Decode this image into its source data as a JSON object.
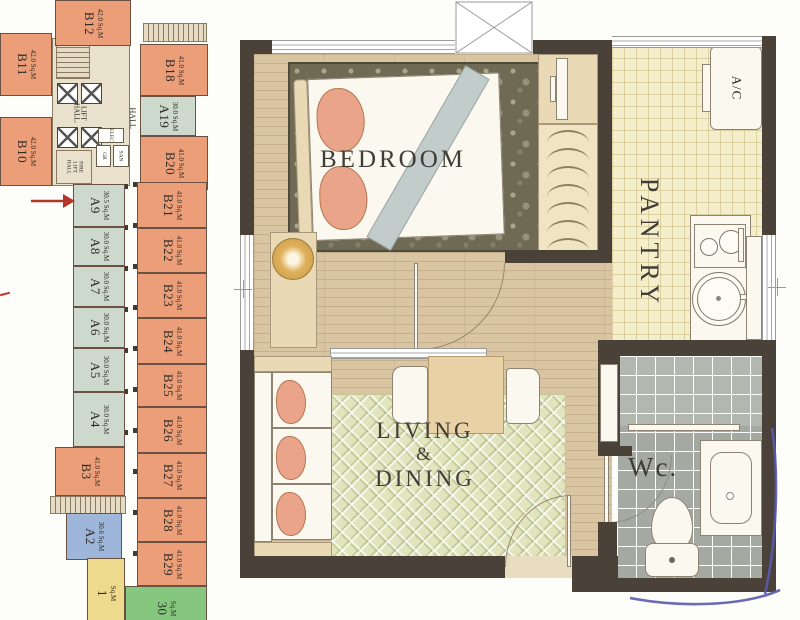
{
  "document": {
    "type": "scanned condominium floor plan"
  },
  "colors": {
    "unit_orange": "#EC9E79",
    "unit_sage": "#CDD9CC",
    "unit_blue": "#9DB6DA",
    "unit_yellow": "#EEDA8C",
    "unit_green": "#85C77F",
    "wall_dark": "#4A4138",
    "wood_floor": "#D9C5A1",
    "pantry_floor": "#F4EECA",
    "wc_tile": "#A4AAA1",
    "bedroom_rug": "#6E6A54",
    "living_rug": "#E1E4BD",
    "pillow_salmon": "#E9A489",
    "arrow_red": "#B5372A",
    "pen_blue": "#5A5AAD"
  },
  "left_plan": {
    "marker": {
      "shape": "arrow",
      "color": "#B5372A",
      "points_to": "A9"
    },
    "core": {
      "lift_hall_line1": "LIFT",
      "lift_hall_line2": "HALL.",
      "hall": "HALL",
      "fire_line1": "FIRE",
      "fire_line2": "LIFT",
      "fire_line3": "HALL",
      "elec": "ELEC",
      "gr": "GR",
      "san": "SAN"
    },
    "units": [
      {
        "label": "B12",
        "area": "42.0 Sq.M"
      },
      {
        "label": "B11",
        "area": "42.0 Sq.M"
      },
      {
        "label": "B10",
        "area": "42.0 Sq.M"
      },
      {
        "label": "B18",
        "area": "41.0 Sq.M"
      },
      {
        "label": "A19",
        "area": "30.0 Sq.M"
      },
      {
        "label": "B20",
        "area": "41.0 Sq.M"
      },
      {
        "label": "A9",
        "area": "30.5 Sq.M"
      },
      {
        "label": "A8",
        "area": "30.0 Sq.M"
      },
      {
        "label": "A7",
        "area": "30.0 Sq.M"
      },
      {
        "label": "A6",
        "area": "30.0 Sq.M"
      },
      {
        "label": "A5",
        "area": "30.0 Sq.M"
      },
      {
        "label": "A4",
        "area": "30.0 Sq.M"
      },
      {
        "label": "B21",
        "area": "41.0 Sq.M"
      },
      {
        "label": "B22",
        "area": "41.0 Sq.M"
      },
      {
        "label": "B23",
        "area": "41.0 Sq.M"
      },
      {
        "label": "B24",
        "area": "41.0 Sq.M"
      },
      {
        "label": "B25",
        "area": "41.0 Sq.M"
      },
      {
        "label": "B26",
        "area": "41.0 Sq.M"
      },
      {
        "label": "B27",
        "area": "41.0 Sq.M"
      },
      {
        "label": "B28",
        "area": "41.0 Sq.M"
      },
      {
        "label": "B29",
        "area": "41.0 Sq.M"
      },
      {
        "label": "B3",
        "area": "41.0 Sq.M"
      },
      {
        "label": "A2",
        "area": "30.6 Sq.M"
      },
      {
        "label": "1",
        "area": "Sq.M"
      },
      {
        "label": "30",
        "area": "Sq.M"
      }
    ]
  },
  "unit_plan": {
    "rooms": {
      "bedroom": "BEDROOM",
      "pantry": "PANTRY",
      "living_line1": "LIVING",
      "living_line2": "&",
      "living_line3": "DINING",
      "wc": "Wc.",
      "ac_unit": "A/C"
    }
  }
}
